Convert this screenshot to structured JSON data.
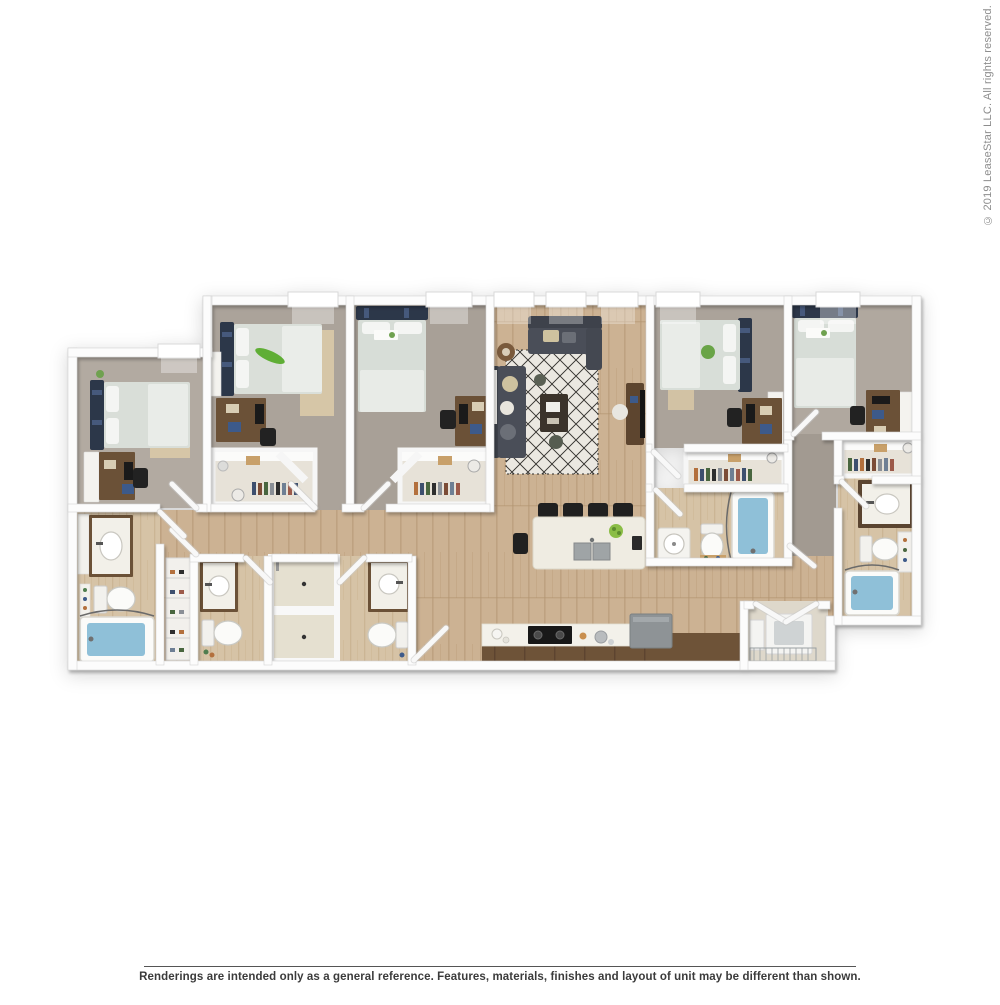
{
  "watermark": {
    "copyright_text": "© 2019 LeaseStar LLC. All rights reserved.",
    "text_color": "#8d8d8d"
  },
  "footer": {
    "disclaimer_text": "Renderings are intended only as a general reference. Features, materials, finishes and layout of unit may be different than shown.",
    "text_color": "#3b3b3b",
    "divider_color": "#555555"
  },
  "floor_plan": {
    "description": "3D top-down dollhouse rendering of a 5-bedroom / 5-bathroom apartment unit with open living room, kitchen island and laundry closet",
    "rooms": [
      {
        "name": "bedroom-1",
        "floor": "carpet",
        "furniture": [
          "bed",
          "desk",
          "chair",
          "dresser"
        ]
      },
      {
        "name": "bedroom-2",
        "floor": "carpet",
        "furniture": [
          "bed",
          "desk",
          "chair",
          "walk-in-closet"
        ]
      },
      {
        "name": "bedroom-3",
        "floor": "carpet",
        "furniture": [
          "bed",
          "desk",
          "chair",
          "walk-in-closet"
        ]
      },
      {
        "name": "bedroom-4",
        "floor": "carpet",
        "furniture": [
          "bed",
          "desk",
          "chair",
          "closet"
        ]
      },
      {
        "name": "bedroom-5",
        "floor": "carpet",
        "furniture": [
          "bed",
          "desk",
          "chair",
          "closet"
        ]
      },
      {
        "name": "living-room",
        "floor": "hardwood",
        "furniture": [
          "sofa",
          "loveseat",
          "area-rug",
          "coffee-table",
          "media-console"
        ]
      },
      {
        "name": "kitchen",
        "floor": "hardwood",
        "furniture": [
          "island",
          "bar-stools",
          "sink",
          "range",
          "refrigerator",
          "counter"
        ]
      },
      {
        "name": "bathroom-1",
        "floor": "tile",
        "furniture": [
          "vanity",
          "toilet",
          "bathtub"
        ]
      },
      {
        "name": "bathroom-2",
        "floor": "tile",
        "furniture": [
          "vanity",
          "toilet",
          "shower"
        ]
      },
      {
        "name": "bathroom-3",
        "floor": "tile",
        "furniture": [
          "vanity",
          "toilet",
          "shower"
        ]
      },
      {
        "name": "bathroom-4",
        "floor": "tile",
        "furniture": [
          "sink",
          "toilet",
          "bathtub"
        ]
      },
      {
        "name": "bathroom-5",
        "floor": "tile",
        "furniture": [
          "vanity",
          "toilet",
          "bathtub"
        ]
      },
      {
        "name": "laundry-closet",
        "floor": "tile",
        "furniture": [
          "washer",
          "hamper"
        ]
      },
      {
        "name": "hallway",
        "floor": "hardwood",
        "furniture": [
          "shoe-rack"
        ]
      }
    ],
    "colors": {
      "walls": "#fcfcfc",
      "carpet": "#aaa29b",
      "hardwood": "#ccb293",
      "bath_floor": "#d6c3a6",
      "headboard_navy": "#2c3749",
      "bedding": "#d9ded8",
      "sofa_gray": "#474b55",
      "tub_water": "#8fc0d8",
      "furniture_wood": "#6b5137",
      "countertop": "#f3f1ea",
      "appliance_gray": "#8e9396",
      "accent_green": "#5fae35"
    }
  }
}
